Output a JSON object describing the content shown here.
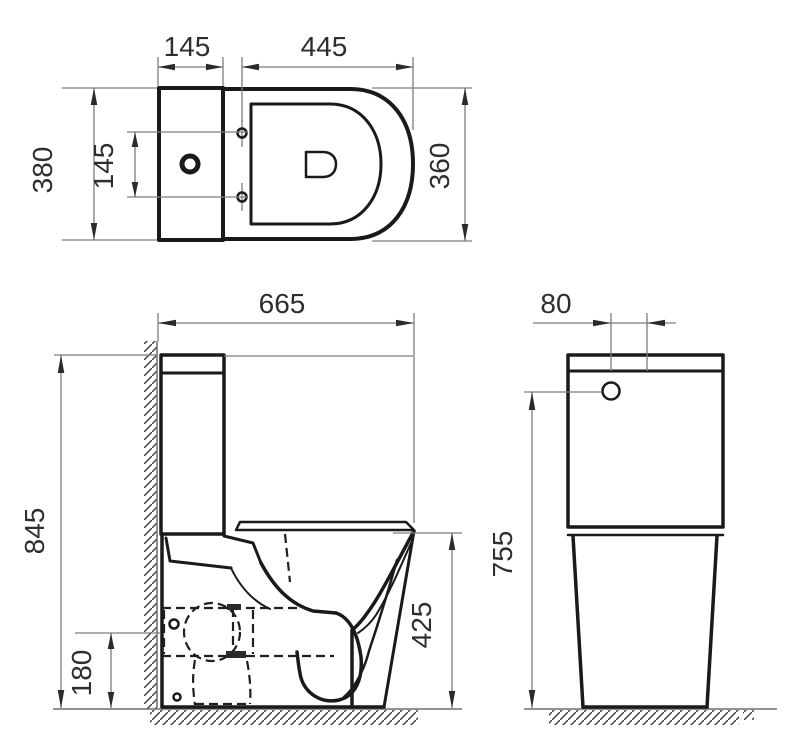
{
  "drawing": {
    "title": "toilet-technical-drawing",
    "views": {
      "top": "plan view of close-coupled toilet (cistern + D-shaped seat)",
      "side": "side elevation against wall with hidden trapway outlet",
      "front": "front elevation of cistern and pedestal"
    }
  },
  "dimensions": {
    "top_tank_depth": "145",
    "top_bowl_length": "445",
    "top_overall_width": "380",
    "top_bolt_spacing": "145",
    "top_bowl_width": "360",
    "side_overall_depth": "665",
    "side_overall_height": "845",
    "side_outlet_height": "180",
    "side_bowl_height": "425",
    "front_button_offset": "80",
    "front_cistern_height": "755"
  },
  "colors": {
    "line": "#1a1a1a",
    "dimension": "#7d7d7d",
    "text": "#2e2e2e",
    "hatch": "#3f3f3f",
    "background": "#ffffff"
  }
}
